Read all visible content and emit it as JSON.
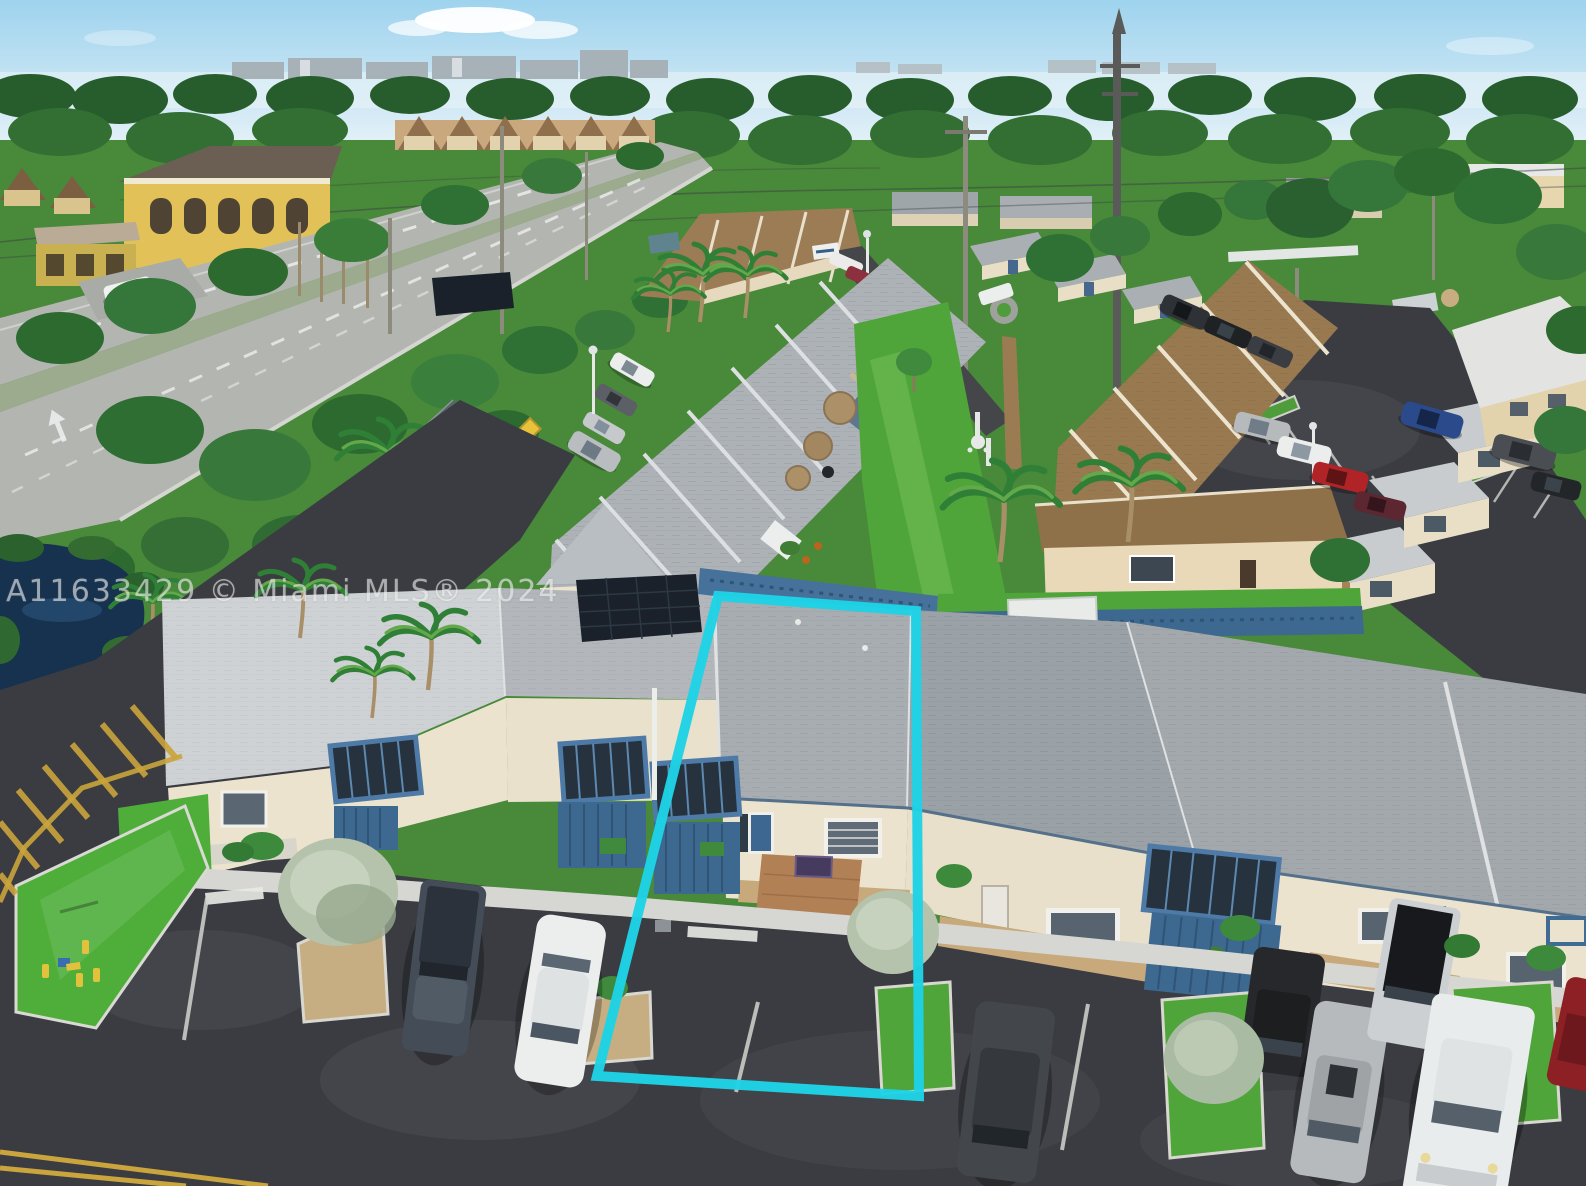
{
  "photo": {
    "watermark": "A11633429 © Miami MLS® 2024",
    "subject": "aerial-view-townhouse-community-with-highlighted-unit"
  },
  "highlight": {
    "outline_color": "#1ed3e5"
  },
  "palette": {
    "sky": "#9ed3ee",
    "sky_low": "#e6f2f8",
    "field": "#49893a",
    "lawn": "#4fa539",
    "lawn_bright": "#4fae3a",
    "tree_dark": "#2c6a30",
    "tree_mid": "#35763a",
    "sage": "#b5c3ac",
    "road": "#b3b5b0",
    "asphalt": "#3a3c41",
    "asphalt_dark": "#34363b",
    "roof_white": "#cfd2d4",
    "roof_gray": "#a8adb2",
    "roof_dark": "#9aa1a7",
    "roof_brown": "#997a50",
    "ridge_cream": "#ece4cf",
    "wall_cream": "#ece3cf",
    "wall_yellow": "#e2c258",
    "fence_blue": "#3d6890",
    "pergola_blue": "#4d7aa6",
    "umbrella_tan": "#ab9068",
    "pond": "#16324f",
    "hatch_yellow": "#caa43c",
    "marking_white": "#e9eae6",
    "gravel_tan": "#c6ae82"
  }
}
